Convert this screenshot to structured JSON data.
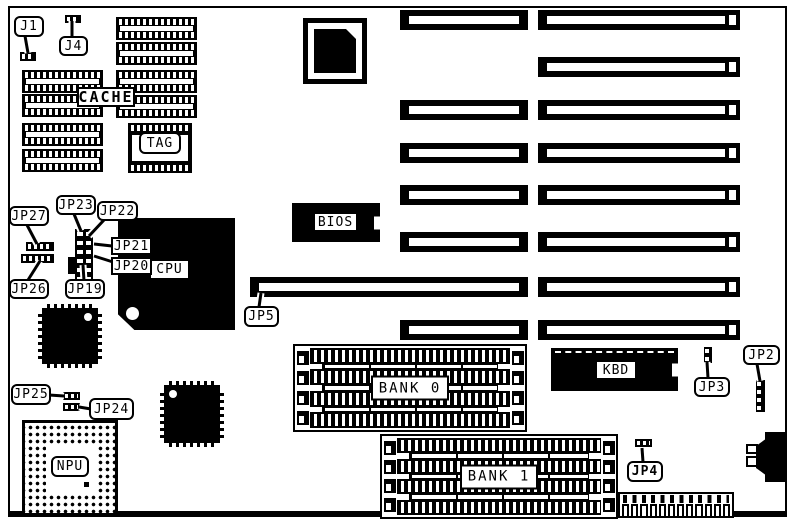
{
  "diagram": {
    "part_number": "MH0090",
    "description": "Motherboard jumper-location diagram"
  },
  "labels": {
    "j1": "J1",
    "j4": "J4",
    "cache": "CACHE",
    "tag": "TAG",
    "jp27": "JP27",
    "jp26": "JP26",
    "jp23": "JP23",
    "jp22": "JP22",
    "jp21": "JP21",
    "jp20": "JP20",
    "jp19": "JP19",
    "cpu": "CPU",
    "jp5": "JP5",
    "bios": "BIOS",
    "jp25": "JP25",
    "jp24": "JP24",
    "npu": "NPU",
    "bank0": "BANK 0",
    "bank1": "BANK 1",
    "kbd": "KBD",
    "jp3": "JP3",
    "jp2": "JP2",
    "jp4": "JP4"
  },
  "colors": {
    "ink": "#000000",
    "paper": "#ffffff"
  }
}
